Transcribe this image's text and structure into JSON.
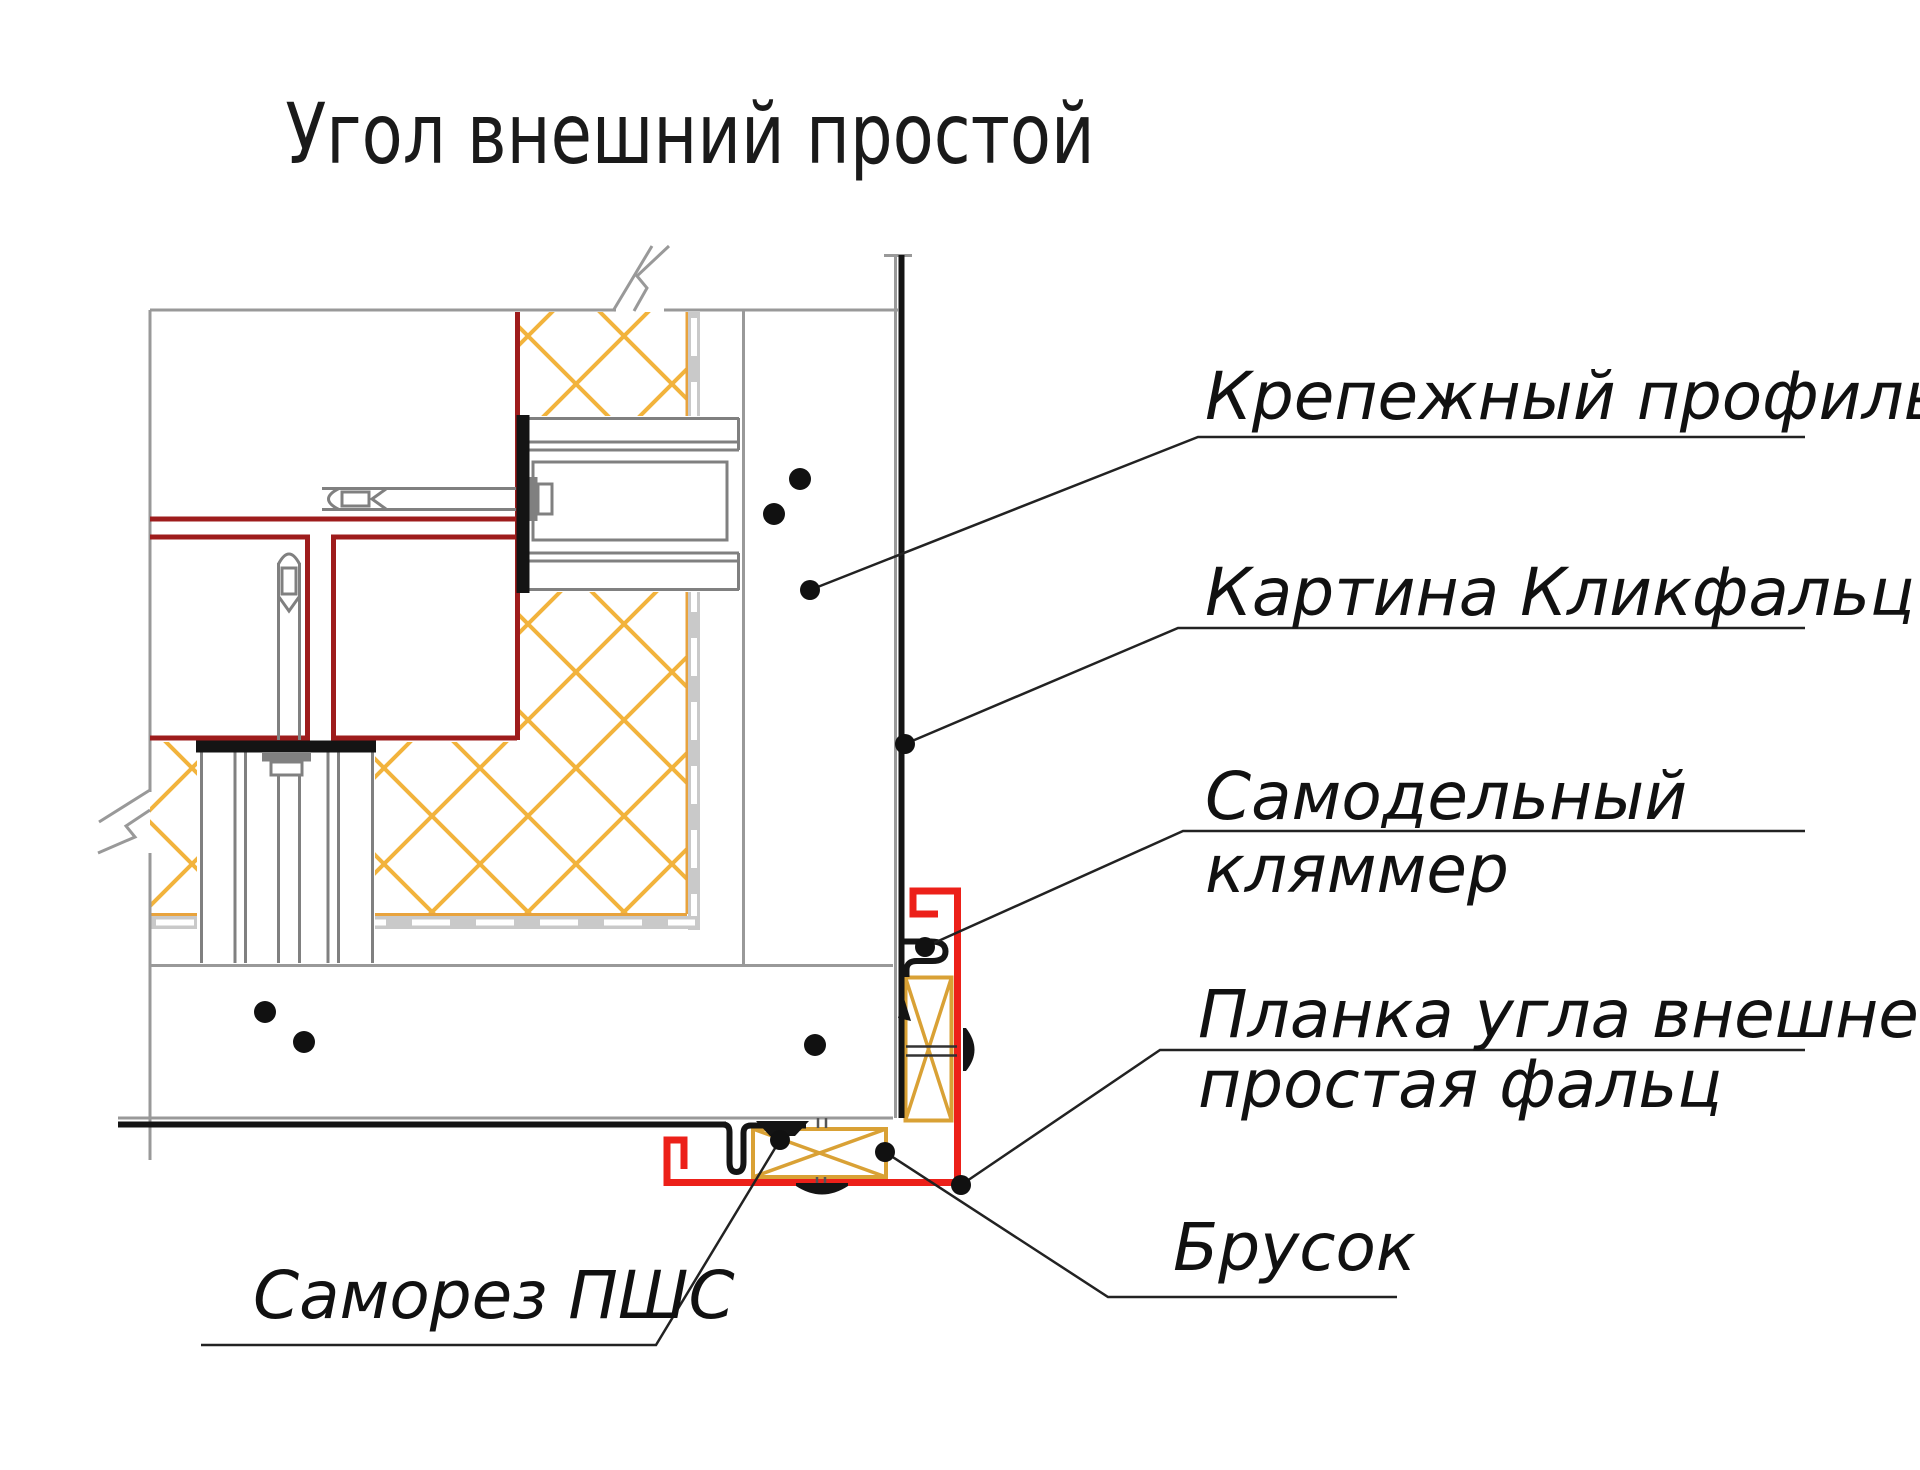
{
  "title": "Угол внешний простой",
  "labels": {
    "fastening_profile": "Крепежный профиль",
    "clickfalz_panel": "Картина Кликфальц",
    "homemade_clamp_line1": "Самодельный",
    "homemade_clamp_line2": "кляммер",
    "corner_strip_line1": "Планка угла внешнего",
    "corner_strip_line2": "простая фальц",
    "wood_block": "Брусок",
    "screw": "Саморез ПШС"
  },
  "colors": {
    "red_profile": "#EC2019",
    "structure_red": "#9E1C1C",
    "insulation": "#F2B33C",
    "wood": "#D9A135",
    "line_gray": "#999999",
    "bracket_gray": "#808080",
    "ink_black": "#141414"
  }
}
